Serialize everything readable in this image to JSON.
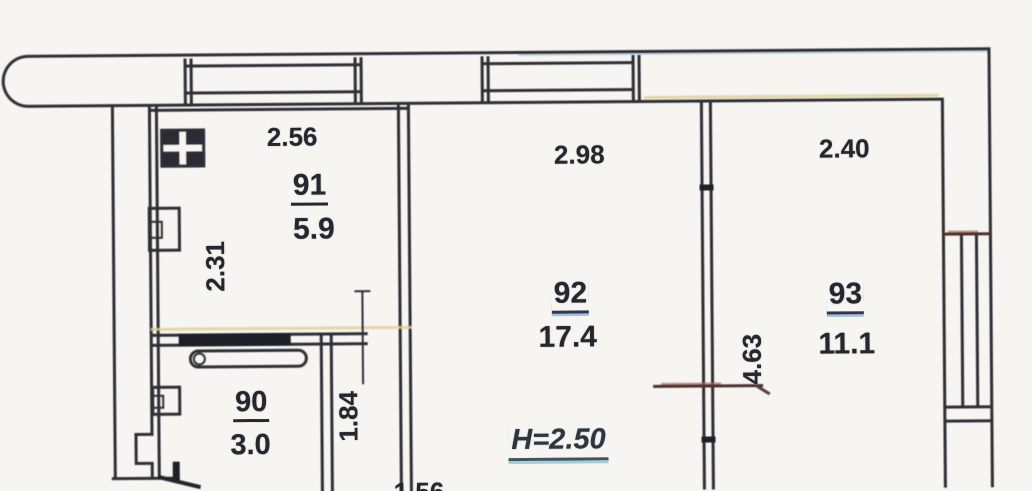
{
  "plan": {
    "ceiling_height": "H=2.50",
    "rooms": [
      {
        "number": "91",
        "area": "5.9"
      },
      {
        "number": "92",
        "area": "17.4"
      },
      {
        "number": "93",
        "area": "11.1"
      },
      {
        "number": "90",
        "area": "3.0"
      }
    ],
    "dimensions": {
      "room91_width": "2.56",
      "room91_depth": "2.31",
      "room92_width": "2.98",
      "room93_width": "2.40",
      "room93_depth": "4.63",
      "hall_depth": "1.84",
      "bottom_width": "1.56"
    },
    "fixtures": [
      "stove",
      "sink",
      "bathtub",
      "washbasin",
      "balcony-railing",
      "window"
    ],
    "colors": {
      "line": "#2e2e36",
      "background": "#f6f5f1",
      "underline_teal": "#5aa0b0",
      "tinge_yellow": "#e0cf96",
      "tinge_red": "#b06a5a"
    }
  }
}
